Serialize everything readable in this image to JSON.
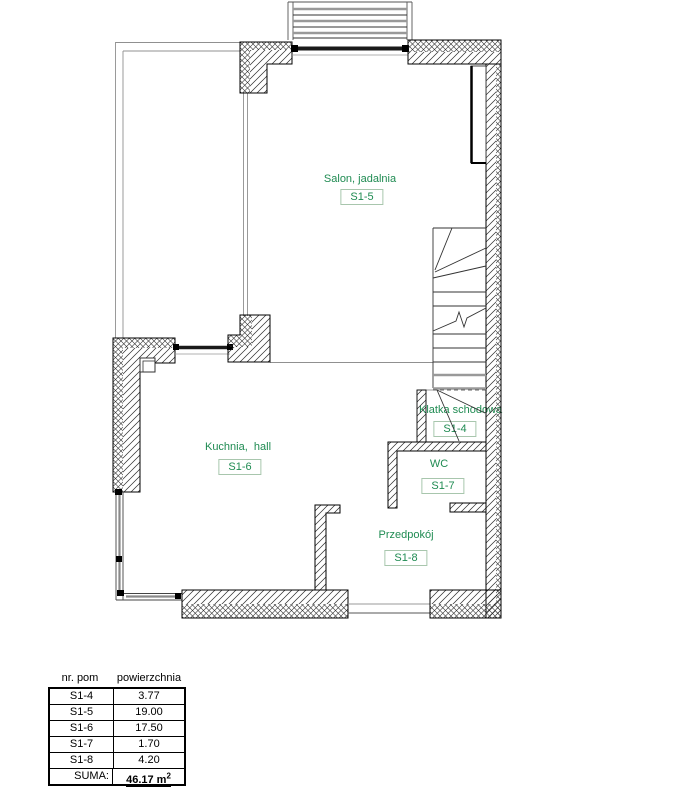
{
  "plan": {
    "rooms": [
      {
        "name": "Salon, jadalnia",
        "code": "S1-5"
      },
      {
        "name": "Kuchnia,  hall",
        "code": "S1-6"
      },
      {
        "name": "Klatka schodowa",
        "code": "S1-4"
      },
      {
        "name": "WC",
        "code": "S1-7"
      },
      {
        "name": "Przedpokój",
        "code": "S1-8"
      }
    ],
    "colors": {
      "room_label_green": "#1f8b52",
      "code_box_border": "#a8c6ad",
      "wall_line": "#000000",
      "construction_line": "#909090"
    }
  },
  "table": {
    "headers": [
      "nr. pom",
      "powierzchnia"
    ],
    "rows": [
      [
        "S1-4",
        "3.77"
      ],
      [
        "S1-5",
        "19.00"
      ],
      [
        "S1-6",
        "17.50"
      ],
      [
        "S1-7",
        "1.70"
      ],
      [
        "S1-8",
        "4.20"
      ]
    ],
    "total_label": "SUMA:",
    "total_value": "46.17 m",
    "total_sup": "2"
  }
}
